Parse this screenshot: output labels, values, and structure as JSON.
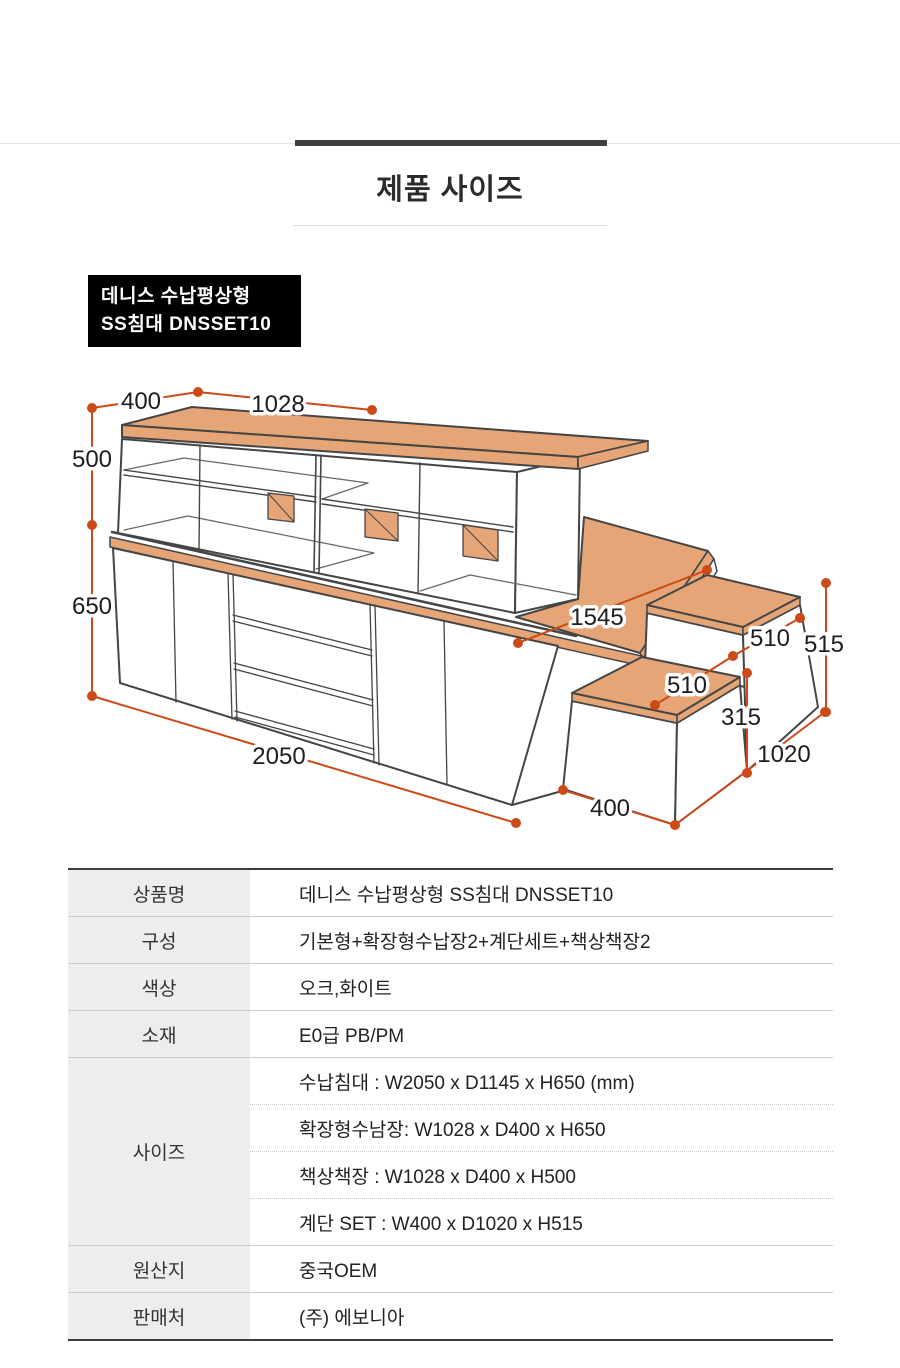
{
  "header": {
    "title": "제품 사이즈"
  },
  "product_label": {
    "line1": "데니스 수납평상형",
    "line2": "SS침대 DNSSET10"
  },
  "diagram": {
    "colors": {
      "wood": "#e6a576",
      "outline": "#454545",
      "dimension": "#cc4a17"
    },
    "dims": {
      "top_depth": "400",
      "top_width": "1028",
      "shelf_height": "500",
      "base_height": "650",
      "base_width": "2050",
      "bed_edge": "1545",
      "step_upper_depth": "510",
      "step_total_height": "515",
      "step_lower_depth": "510",
      "step_lower_height": "315",
      "step_total_depth": "1020",
      "step_width": "400"
    }
  },
  "spec_table": {
    "rows": [
      {
        "label": "상품명",
        "value": "데니스 수납평상형 SS침대 DNSSET10"
      },
      {
        "label": "구성",
        "value": "기본형+확장형수납장2+계단세트+책상책장2"
      },
      {
        "label": "색상",
        "value": "오크,화이트"
      },
      {
        "label": "소재",
        "value": "E0급 PB/PM"
      },
      {
        "label": "사이즈",
        "values": [
          "수납침대 :  W2050 x D1145 x H650 (mm)",
          "확장형수남장: W1028 x D400 x H650",
          "책상책장 :  W1028 x D400 x H500",
          "계단 SET :  W400 x D1020 x H515"
        ]
      },
      {
        "label": "원산지",
        "value": "중국OEM"
      },
      {
        "label": "판매처",
        "value": "(주) 에보니아"
      }
    ]
  }
}
